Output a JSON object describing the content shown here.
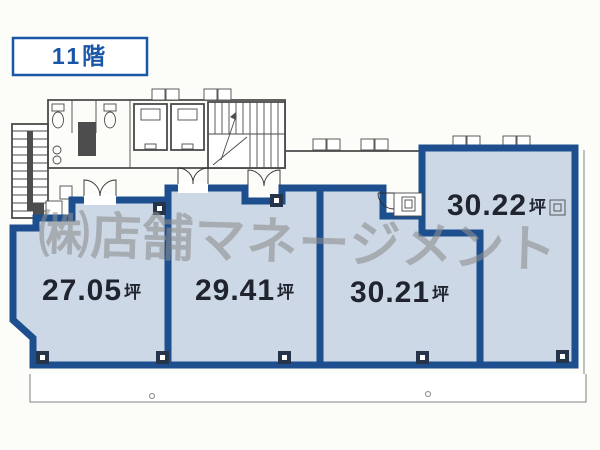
{
  "floor_badge": {
    "label": "11階"
  },
  "watermark": {
    "text": "㈱店舗マネージメント"
  },
  "unit": "坪",
  "rooms": [
    {
      "id": "room-a",
      "area": "27.05"
    },
    {
      "id": "room-b",
      "area": "29.41"
    },
    {
      "id": "room-c",
      "area": "30.21"
    },
    {
      "id": "room-d",
      "area": "30.22"
    }
  ],
  "colors": {
    "wall_blue": "#2e6cb5",
    "wall_dark": "#1d4e8e",
    "room_fill": "#ccd8e6",
    "line_gray": "#4a4a4a",
    "light_gray": "#9a9a9a",
    "watermark_gray": "#8e8e8e",
    "label_dark": "#20242e",
    "accent_blue": "#1a56a8",
    "paper": "#fcfcf8"
  }
}
